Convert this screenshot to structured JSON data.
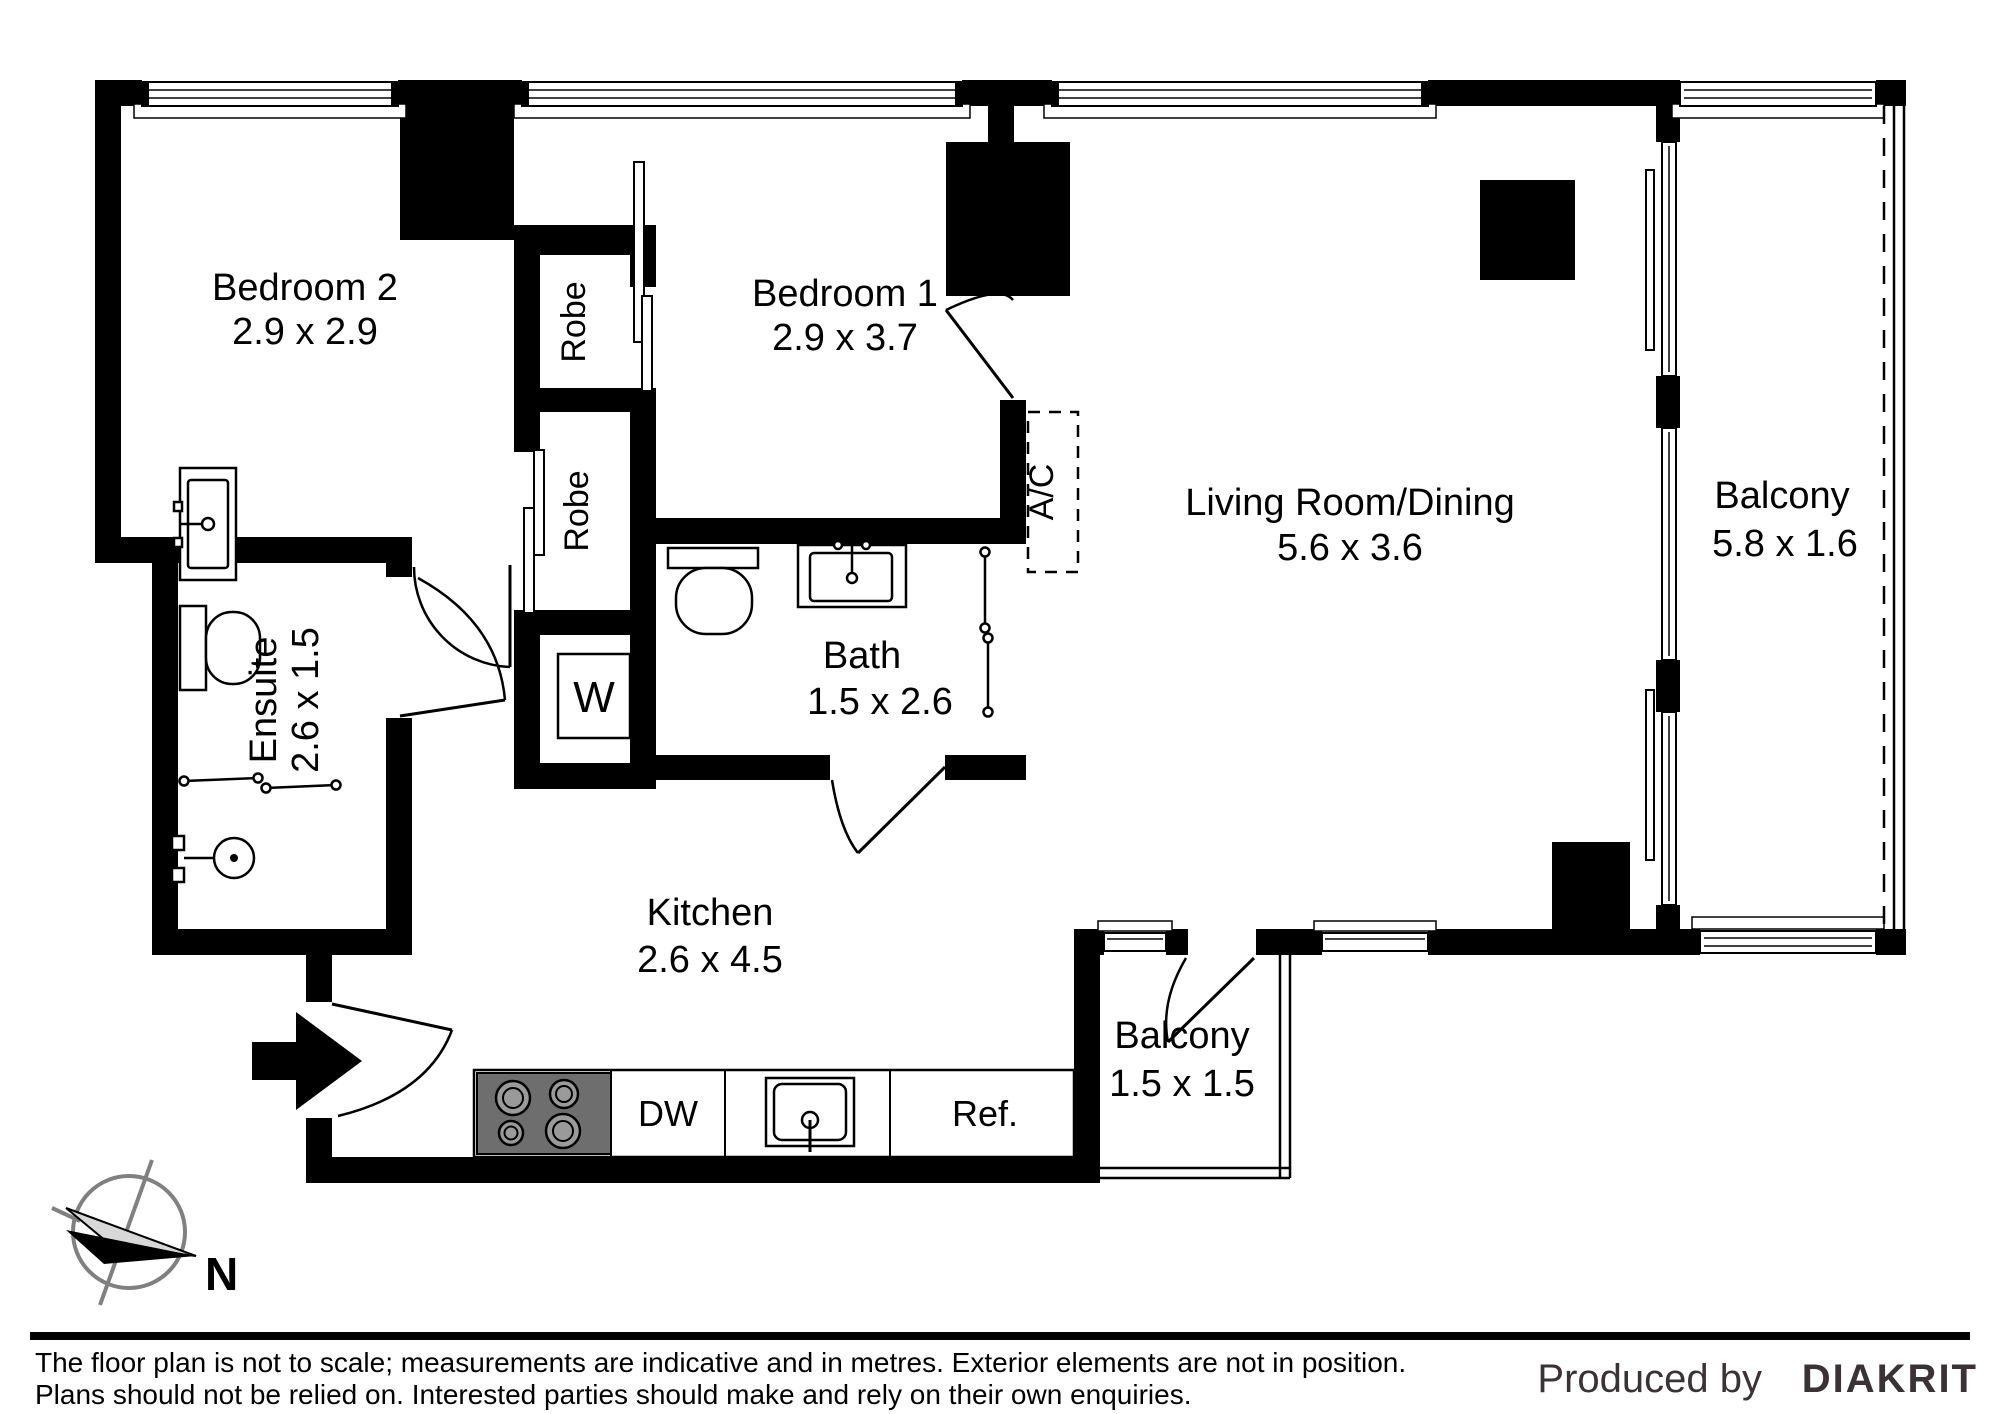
{
  "labels": {
    "bedroom2": {
      "name": "Bedroom 2",
      "dims": "2.9 x 2.9"
    },
    "bedroom1": {
      "name": "Bedroom 1",
      "dims": "2.9 x 3.7"
    },
    "living": {
      "name": "Living Room/Dining",
      "dims": "5.6 x 3.6"
    },
    "balcony_main": {
      "name": "Balcony",
      "dims": "5.8 x 1.6"
    },
    "balcony_small": {
      "name": "Balcony",
      "dims": "1.5 x 1.5"
    },
    "ensuite": {
      "name": "Ensuite",
      "dims": "2.6 x 1.5"
    },
    "bath": {
      "name": "Bath",
      "dims": "1.5 x 2.6"
    },
    "kitchen": {
      "name": "Kitchen",
      "dims": "2.6 x 4.5"
    },
    "robe_upper": {
      "name": "Robe"
    },
    "robe_lower": {
      "name": "Robe"
    }
  },
  "fixtures": {
    "laundry": "W",
    "air_conditioner": "A/C",
    "dishwasher": "DW",
    "refrigerator": "Ref."
  },
  "compass": {
    "north": "N"
  },
  "footer": {
    "disclaimer_line1": "The floor plan is not to scale; measurements are indicative and in metres. Exterior elements are not in position.",
    "disclaimer_line2": "Plans should not be relied on. Interested parties should make and rely on their own enquiries.",
    "credit_prefix": "Produced by",
    "credit_brand": "DIAKRIT"
  },
  "colors": {
    "wall": "#000000",
    "stove": "#6e6e6e",
    "credit": "#3a3335",
    "compass_ring": "#808080"
  }
}
